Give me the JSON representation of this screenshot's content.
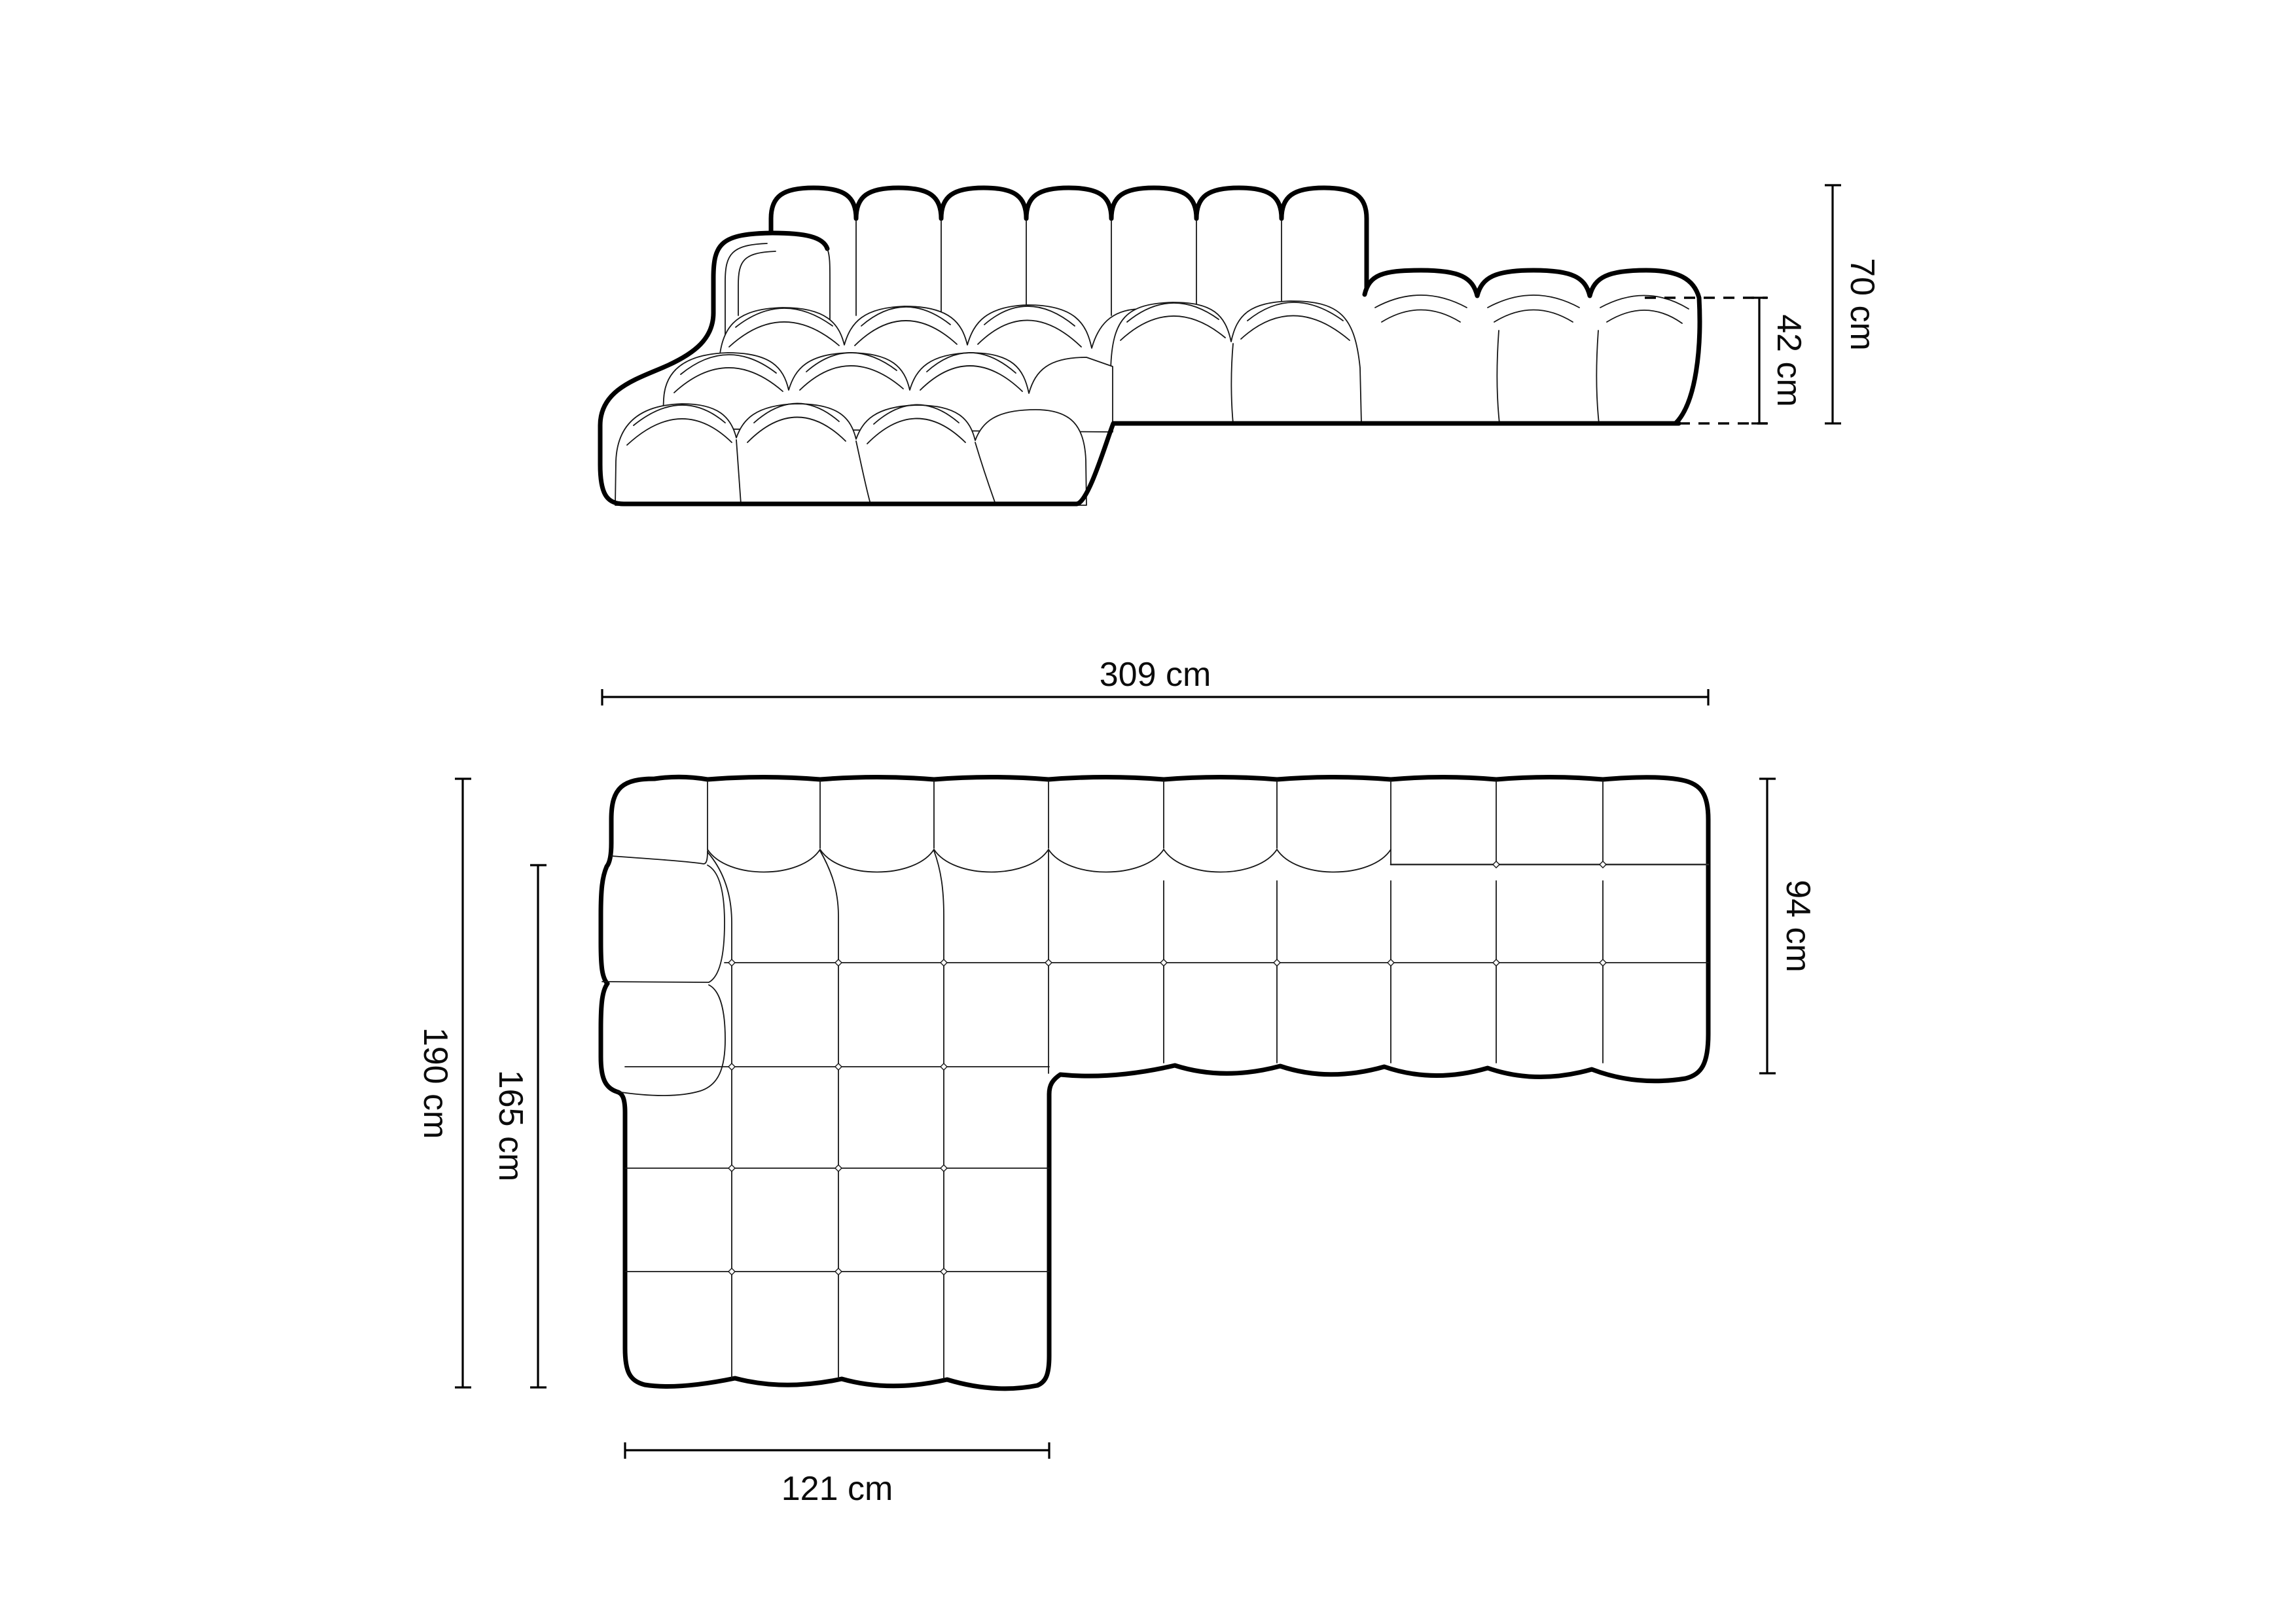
{
  "page": {
    "background": "#ffffff",
    "line_color": "#000000",
    "subject": "modular corner sofa technical dimension drawing"
  },
  "front_view": {
    "view_name": "front-elevation",
    "dim_total_height": {
      "label": "70 cm"
    },
    "dim_seat_height": {
      "label": "42 cm"
    }
  },
  "plan_view": {
    "view_name": "top-plan",
    "dim_total_width": {
      "label": "309 cm"
    },
    "dim_right_depth": {
      "label": "94 cm"
    },
    "dim_left_depth": {
      "label": "190 cm"
    },
    "dim_chaise_length": {
      "label": "165 cm"
    },
    "dim_chaise_width": {
      "label": "121 cm"
    }
  }
}
